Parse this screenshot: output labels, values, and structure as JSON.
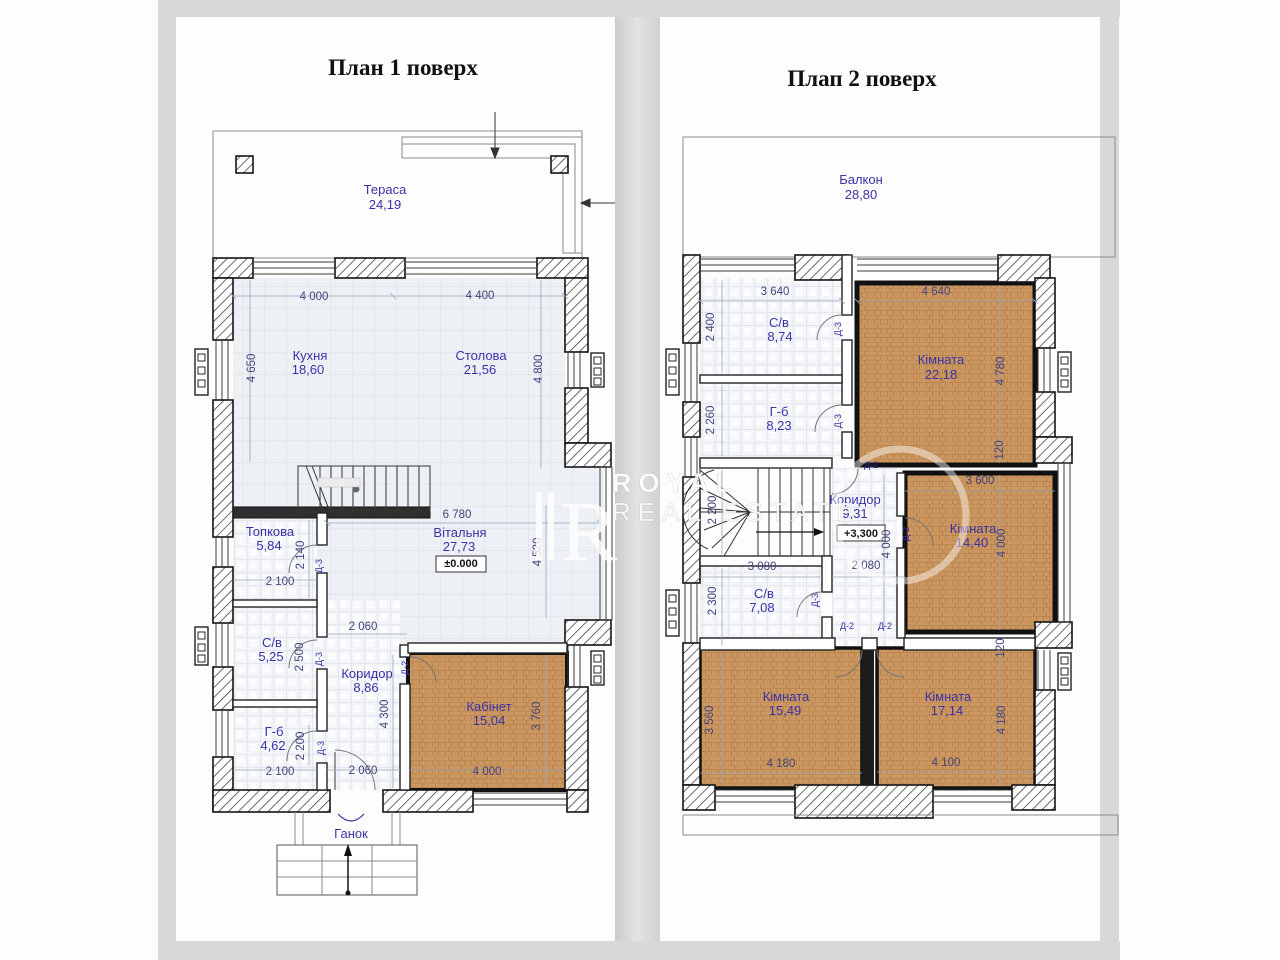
{
  "colors": {
    "label": "#3b32a8",
    "dim": "#44447e",
    "brown": "#cb965f",
    "wall": "#141414",
    "frame": "#d8d8d8"
  },
  "watermark": {
    "line1": "ROYAL",
    "line2": "REAL ESTATE",
    "logo_letter": "R"
  },
  "floor1": {
    "title": "План 1 поверх",
    "labels": [
      {
        "t": "Тераса",
        "x": 385,
        "y": 194,
        "cls": "room"
      },
      {
        "t": "24,19",
        "x": 385,
        "y": 209,
        "cls": "room"
      },
      {
        "t": "Кухня",
        "x": 310,
        "y": 360,
        "cls": "room"
      },
      {
        "t": "18,60",
        "x": 308,
        "y": 374,
        "cls": "room"
      },
      {
        "t": "Столова",
        "x": 481,
        "y": 360,
        "cls": "room"
      },
      {
        "t": "21,56",
        "x": 480,
        "y": 374,
        "cls": "room"
      },
      {
        "t": "Вітальня",
        "x": 460,
        "y": 537,
        "cls": "room"
      },
      {
        "t": "27,73",
        "x": 459,
        "y": 551,
        "cls": "room"
      },
      {
        "t": "Топкова",
        "x": 270,
        "y": 536,
        "cls": "room"
      },
      {
        "t": "5,84",
        "x": 269,
        "y": 550,
        "cls": "room"
      },
      {
        "t": "С/в",
        "x": 272,
        "y": 647,
        "cls": "room"
      },
      {
        "t": "5,25",
        "x": 271,
        "y": 661,
        "cls": "room"
      },
      {
        "t": "Коридор",
        "x": 367,
        "y": 678,
        "cls": "room"
      },
      {
        "t": "8,86",
        "x": 366,
        "y": 692,
        "cls": "room"
      },
      {
        "t": "Г-б",
        "x": 274,
        "y": 736,
        "cls": "room"
      },
      {
        "t": "4,62",
        "x": 273,
        "y": 750,
        "cls": "room"
      },
      {
        "t": "Кабінет",
        "x": 489,
        "y": 711,
        "cls": "room"
      },
      {
        "t": "15,04",
        "x": 489,
        "y": 725,
        "cls": "room"
      },
      {
        "t": "Ганок",
        "x": 351,
        "y": 838,
        "cls": "room"
      },
      {
        "t": "4 000",
        "x": 314,
        "y": 300,
        "cls": "dim"
      },
      {
        "t": "4 400",
        "x": 480,
        "y": 299,
        "cls": "dim"
      },
      {
        "t": "4 650",
        "x": 255,
        "y": 368,
        "r": -90,
        "cls": "dim"
      },
      {
        "t": "4 800",
        "x": 542,
        "y": 369,
        "r": -90,
        "cls": "dim"
      },
      {
        "t": "6 780",
        "x": 457,
        "y": 518,
        "cls": "dim"
      },
      {
        "t": "4 520",
        "x": 541,
        "y": 552,
        "r": -90,
        "cls": "dim"
      },
      {
        "t": "2 140",
        "x": 304,
        "y": 555,
        "r": -90,
        "cls": "dim"
      },
      {
        "t": "2 100",
        "x": 280,
        "y": 585,
        "cls": "dim"
      },
      {
        "t": "2 060",
        "x": 363,
        "y": 630,
        "cls": "dim"
      },
      {
        "t": "2 500",
        "x": 303,
        "y": 657,
        "r": -90,
        "cls": "dim"
      },
      {
        "t": "4 300",
        "x": 388,
        "y": 714,
        "r": -90,
        "cls": "dim"
      },
      {
        "t": "2 200",
        "x": 304,
        "y": 746,
        "r": -90,
        "cls": "dim"
      },
      {
        "t": "2 100",
        "x": 280,
        "y": 775,
        "cls": "dim"
      },
      {
        "t": "2 060",
        "x": 363,
        "y": 774,
        "cls": "dim"
      },
      {
        "t": "3 760",
        "x": 540,
        "y": 716,
        "r": -90,
        "cls": "dim"
      },
      {
        "t": "4 000",
        "x": 487,
        "y": 775,
        "cls": "dim"
      },
      {
        "t": "Д-3",
        "x": 322,
        "y": 566,
        "r": -90,
        "cls": "door"
      },
      {
        "t": "Д-3",
        "x": 322,
        "y": 659,
        "r": -90,
        "cls": "door"
      },
      {
        "t": "Д-3",
        "x": 324,
        "y": 748,
        "r": -90,
        "cls": "door"
      },
      {
        "t": "Д-2",
        "x": 408,
        "y": 668,
        "r": -90,
        "cls": "door"
      },
      {
        "t": "±0.000",
        "x": 461,
        "y": 567,
        "cls": "mark"
      }
    ]
  },
  "floor2": {
    "title": "Плап 2 поверх",
    "labels": [
      {
        "t": "Балкон",
        "x": 861,
        "y": 184,
        "cls": "room"
      },
      {
        "t": "28,80",
        "x": 861,
        "y": 199,
        "cls": "room"
      },
      {
        "t": "С/в",
        "x": 779,
        "y": 327,
        "cls": "room"
      },
      {
        "t": "8,74",
        "x": 780,
        "y": 341,
        "cls": "room"
      },
      {
        "t": "Кімната",
        "x": 941,
        "y": 364,
        "cls": "room"
      },
      {
        "t": "22,18",
        "x": 941,
        "y": 379,
        "cls": "room"
      },
      {
        "t": "Г-б",
        "x": 779,
        "y": 416,
        "cls": "room"
      },
      {
        "t": "8,23",
        "x": 779,
        "y": 430,
        "cls": "room"
      },
      {
        "t": "Коридор",
        "x": 855,
        "y": 504,
        "cls": "room"
      },
      {
        "t": "9,31",
        "x": 855,
        "y": 518,
        "cls": "room"
      },
      {
        "t": "Кімната",
        "x": 973,
        "y": 533,
        "cls": "room"
      },
      {
        "t": "14,40",
        "x": 972,
        "y": 547,
        "cls": "room"
      },
      {
        "t": "С/в",
        "x": 764,
        "y": 598,
        "cls": "room"
      },
      {
        "t": "7,08",
        "x": 762,
        "y": 612,
        "cls": "room"
      },
      {
        "t": "Кімната",
        "x": 786,
        "y": 701,
        "cls": "room"
      },
      {
        "t": "15,49",
        "x": 785,
        "y": 715,
        "cls": "room"
      },
      {
        "t": "Кімната",
        "x": 948,
        "y": 701,
        "cls": "room"
      },
      {
        "t": "17,14",
        "x": 947,
        "y": 715,
        "cls": "room"
      },
      {
        "t": "3 640",
        "x": 775,
        "y": 295,
        "cls": "dim"
      },
      {
        "t": "4 640",
        "x": 936,
        "y": 295,
        "cls": "dim"
      },
      {
        "t": "2 400",
        "x": 714,
        "y": 327,
        "r": -90,
        "cls": "dim"
      },
      {
        "t": "2 260",
        "x": 714,
        "y": 420,
        "r": -90,
        "cls": "dim"
      },
      {
        "t": "4 780",
        "x": 1004,
        "y": 371,
        "r": -90,
        "cls": "dim"
      },
      {
        "t": "120",
        "x": 1003,
        "y": 450,
        "r": -90,
        "cls": "dim"
      },
      {
        "t": "2 200",
        "x": 716,
        "y": 510,
        "r": -90,
        "cls": "dim"
      },
      {
        "t": "3 600",
        "x": 980,
        "y": 484,
        "cls": "dim"
      },
      {
        "t": "4 000",
        "x": 890,
        "y": 544,
        "r": -90,
        "cls": "dim"
      },
      {
        "t": "4 000",
        "x": 1005,
        "y": 543,
        "r": -90,
        "cls": "dim"
      },
      {
        "t": "3 080",
        "x": 762,
        "y": 570,
        "cls": "dim"
      },
      {
        "t": "2 080",
        "x": 866,
        "y": 569,
        "cls": "dim"
      },
      {
        "t": "2 300",
        "x": 716,
        "y": 601,
        "r": -90,
        "cls": "dim"
      },
      {
        "t": "120",
        "x": 1004,
        "y": 648,
        "r": -90,
        "cls": "dim"
      },
      {
        "t": "3 560",
        "x": 713,
        "y": 720,
        "r": -90,
        "cls": "dim"
      },
      {
        "t": "4 180",
        "x": 781,
        "y": 767,
        "cls": "dim"
      },
      {
        "t": "4 100",
        "x": 946,
        "y": 766,
        "cls": "dim"
      },
      {
        "t": "4 180",
        "x": 1005,
        "y": 720,
        "r": -90,
        "cls": "dim"
      },
      {
        "t": "Д-3",
        "x": 841,
        "y": 329,
        "r": -90,
        "cls": "door"
      },
      {
        "t": "Д-3",
        "x": 841,
        "y": 421,
        "r": -90,
        "cls": "door"
      },
      {
        "t": "Д-2",
        "x": 871,
        "y": 468,
        "cls": "door"
      },
      {
        "t": "Д-2",
        "x": 909,
        "y": 534,
        "r": -90,
        "cls": "door"
      },
      {
        "t": "Д-3",
        "x": 818,
        "y": 600,
        "r": -90,
        "cls": "door"
      },
      {
        "t": "Д-2",
        "x": 847,
        "y": 629,
        "cls": "door"
      },
      {
        "t": "Д-2",
        "x": 885,
        "y": 629,
        "cls": "door"
      },
      {
        "t": "+3,300",
        "x": 861,
        "y": 537,
        "cls": "mark"
      }
    ]
  }
}
